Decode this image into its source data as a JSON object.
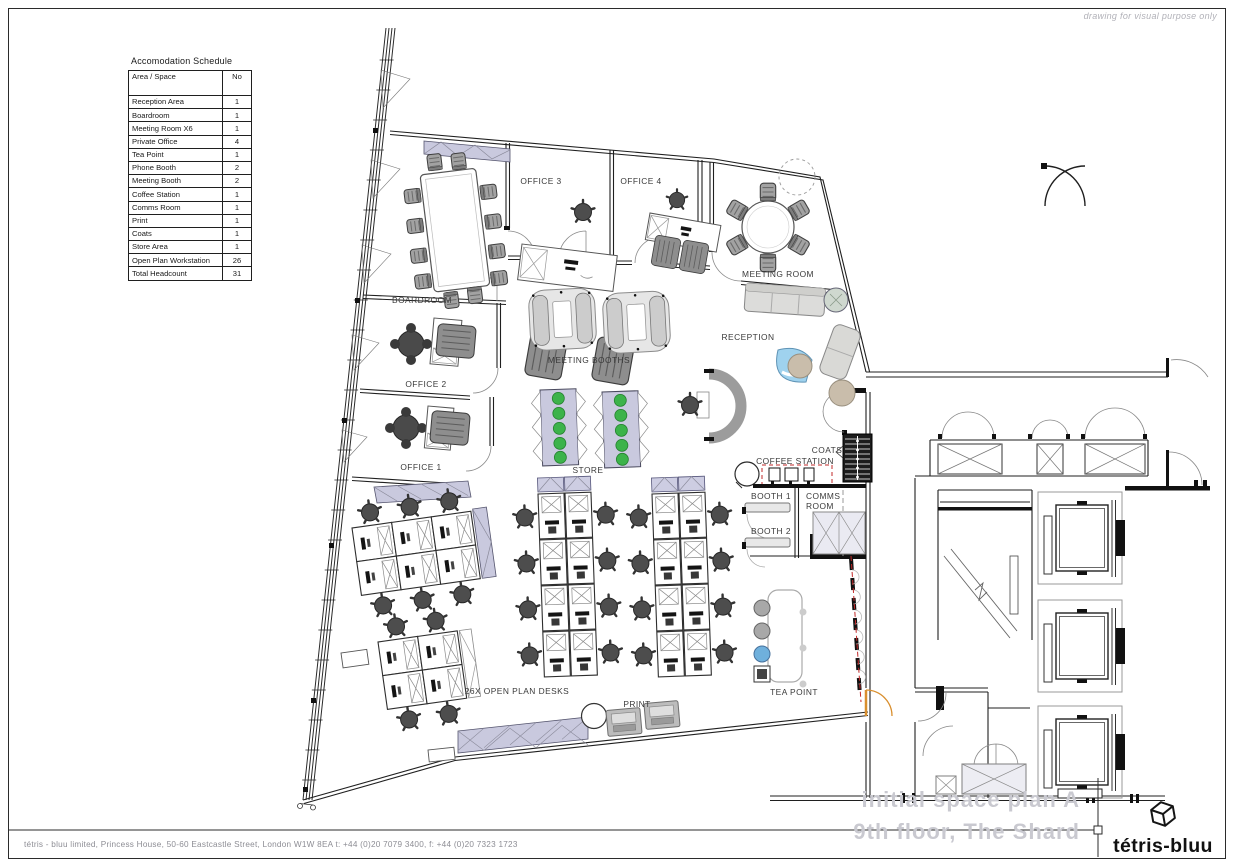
{
  "note": "drawing for visual purpose only",
  "schedule": {
    "title": "Accomodation Schedule",
    "col_area": "Area / Space",
    "col_no": "No",
    "rows": [
      {
        "area": "Reception Area",
        "no": "1"
      },
      {
        "area": "Boardroom",
        "no": "1"
      },
      {
        "area": "Meeting Room X6",
        "no": "1"
      },
      {
        "area": "Private Office",
        "no": "4"
      },
      {
        "area": "Tea Point",
        "no": "1"
      },
      {
        "area": "Phone Booth",
        "no": "2"
      },
      {
        "area": "Meeting Booth",
        "no": "2"
      },
      {
        "area": "Coffee Station",
        "no": "1"
      },
      {
        "area": "Comms Room",
        "no": "1"
      },
      {
        "area": "Print",
        "no": "1"
      },
      {
        "area": "Coats",
        "no": "1"
      },
      {
        "area": "Store Area",
        "no": "1"
      },
      {
        "area": "Open Plan Workstation",
        "no": "26"
      },
      {
        "area": "Total Headcount",
        "no": "31"
      }
    ]
  },
  "plan": {
    "labels": {
      "boardroom": "BOARDROOM",
      "office1": "OFFICE 1",
      "office2": "OFFICE 2",
      "office3": "OFFICE 3",
      "office4": "OFFICE 4",
      "meeting_room": "MEETING ROOM",
      "meeting_booths": "MEETING BOOTHS",
      "reception": "RECEPTION",
      "store": "STORE",
      "coats": "COATS",
      "coffee_station": "COFFEE STATION",
      "booth1": "BOOTH 1",
      "booth2": "BOOTH 2",
      "comms_line1": "COMMS",
      "comms_line2": "ROOM",
      "tea_point": "TEA POINT",
      "open_plan": "26X OPEN PLAN DESKS",
      "print": "PRINT"
    }
  },
  "footer": {
    "address": "tétris - bluu limited, Princess House, 50-60 Eastcastle Street, London W1W 8EA  t: +44 (0)20 7079 3400,  f: +44 (0)20 7323 1723",
    "title_line1": "initial space plan A",
    "title_line2": "9th floor, The Shard",
    "logo": "tétris-bluu"
  },
  "colors": {
    "wall": "#1f1f1f",
    "lavender": "#c9c9de",
    "plant_green": "#3cb34a",
    "reception_blue": "#9fd2ee",
    "stool_blue": "#6fb0dc",
    "tan": "#c9bdab",
    "fire_red": "#c22828",
    "door_orange": "#d98f2e",
    "sheet_title_grey": "#c9c9d0",
    "note_grey": "#b1b1b8"
  }
}
